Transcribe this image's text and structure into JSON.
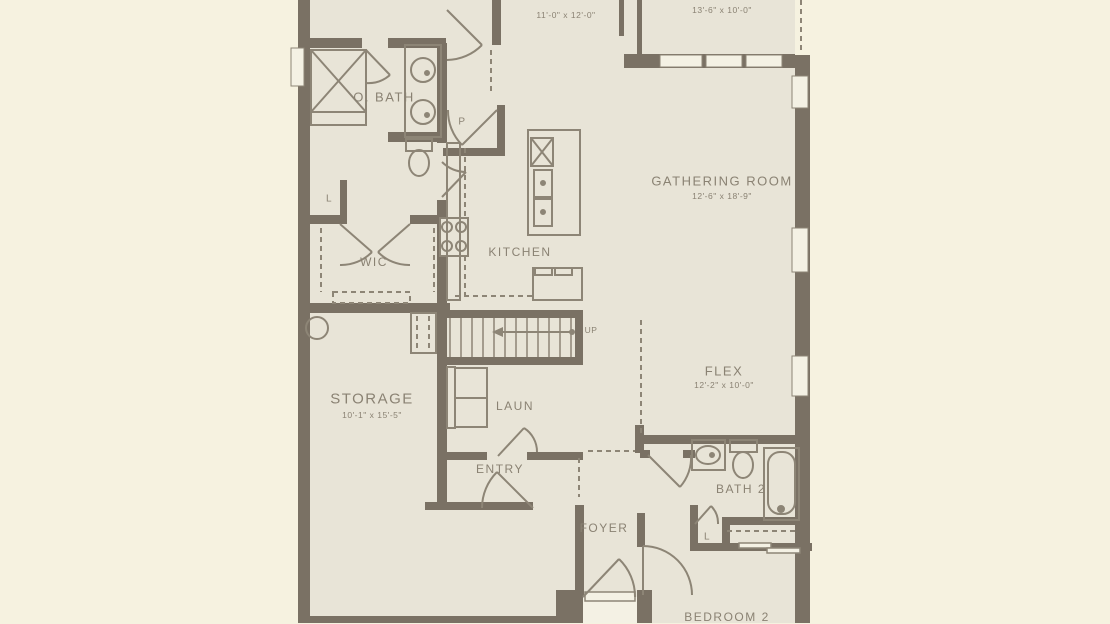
{
  "colors": {
    "bg": "#f6f2e0",
    "floor": "#e8e4d7",
    "wall": "#7a7164",
    "line": "#8d8576",
    "text": "#8a8273",
    "win": "#f4f1e4"
  },
  "rooms": {
    "suite_dims": "11'-0\" x 12'-0\"",
    "lanai_dims": "13'-6\" x 10'-0\"",
    "o_bath": "O. BATH",
    "pantry": "P",
    "gathering": "GATHERING ROOM",
    "gathering_dims": "12'-6\" x 18'-9\"",
    "kitchen": "KITCHEN",
    "wic": "WIC",
    "linen_1": "L",
    "up": "UP",
    "storage": "STORAGE",
    "storage_dims": "10'-1\" x 15'-5\"",
    "laundry": "LAUN",
    "entry": "ENTRY",
    "foyer": "FOYER",
    "flex": "FLEX",
    "flex_dims": "12'-2\" x 10'-0\"",
    "bath2": "BATH 2",
    "linen_2": "L",
    "bedroom2": "BEDROOM 2"
  }
}
